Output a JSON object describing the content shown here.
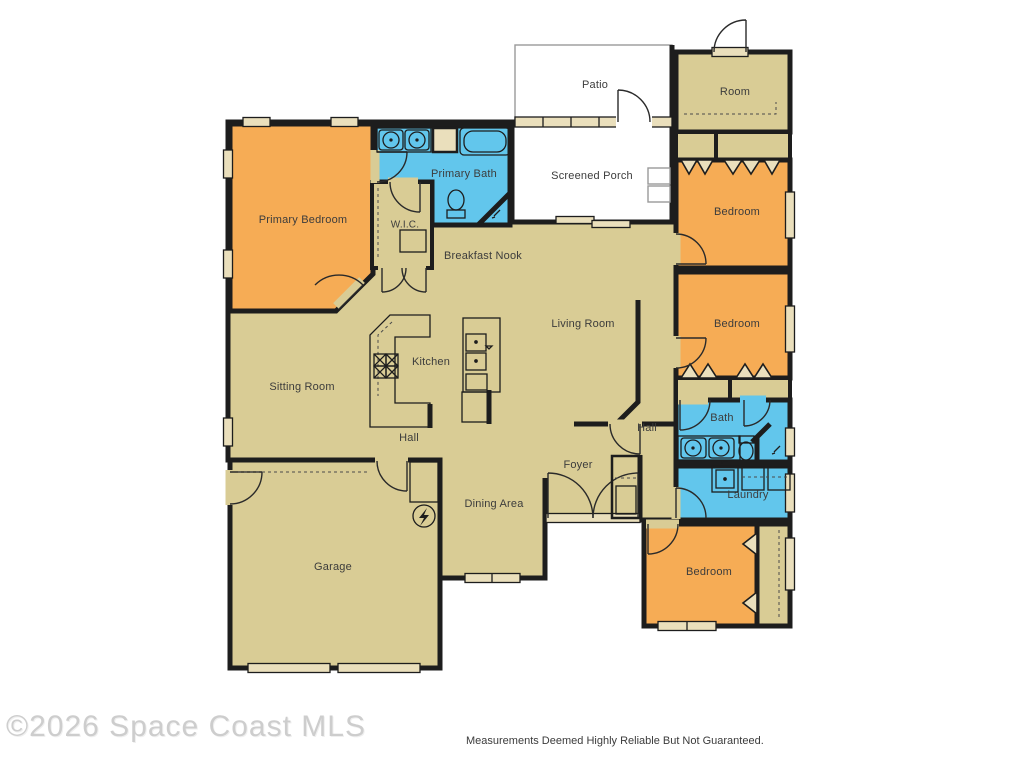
{
  "colors": {
    "floor": "#d9cc95",
    "bedroom": "#f6ac55",
    "bath": "#62c6ec",
    "wall": "#1d1d1d",
    "frame": "#eadfbc",
    "outdoor": "#ffffff",
    "outdoor_outline": "#9a9a9a",
    "label": "#3c3c3c",
    "watermark": "#cdcdcd",
    "disclaimer": "#3b3b3b"
  },
  "rooms": {
    "patio": {
      "label": "Patio"
    },
    "room_tr": {
      "label": "Room"
    },
    "screened_porch": {
      "label": "Screened Porch"
    },
    "primary_bath": {
      "label": "Primary Bath"
    },
    "primary_bedroom": {
      "label": "Primary Bedroom"
    },
    "wic": {
      "label": "W.I.C."
    },
    "breakfast_nook": {
      "label": "Breakfast Nook"
    },
    "living_room": {
      "label": "Living Room"
    },
    "kitchen": {
      "label": "Kitchen"
    },
    "sitting_room": {
      "label": "Sitting Room"
    },
    "hall_left": {
      "label": "Hall"
    },
    "hall_right": {
      "label": "Hall"
    },
    "foyer": {
      "label": "Foyer"
    },
    "dining_area": {
      "label": "Dining Area"
    },
    "garage": {
      "label": "Garage"
    },
    "bedroom_1": {
      "label": "Bedroom"
    },
    "bedroom_2": {
      "label": "Bedroom"
    },
    "bath_2": {
      "label": "Bath"
    },
    "laundry": {
      "label": "Laundry"
    },
    "bedroom_3": {
      "label": "Bedroom"
    }
  },
  "footer": {
    "watermark": "©2026 Space Coast MLS",
    "disclaimer": "Measurements Deemed Highly Reliable But Not Guaranteed."
  }
}
